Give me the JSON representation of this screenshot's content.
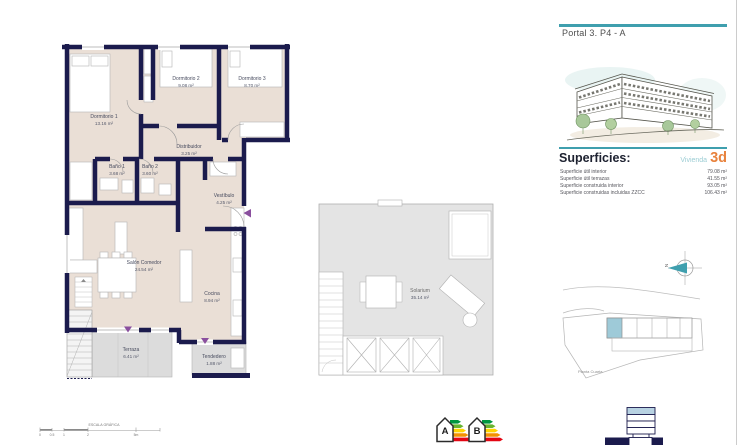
{
  "panel": {
    "portal_title": "Portal 3. P4 - A",
    "superficies_heading": "Superficies:",
    "vivienda_label": "Vivienda",
    "vivienda_code": "3d",
    "surface_rows": [
      {
        "label": "Superficie útil interior",
        "value": "79.08 m²"
      },
      {
        "label": "Superficie útil terrazas",
        "value": "41.55 m²"
      },
      {
        "label": "Superficie construida interior",
        "value": "93.05 m²"
      },
      {
        "label": "Superficie construidas incluidas ZZCC",
        "value": "106.43 m²"
      }
    ],
    "site_plan_caption": "Planta Cuarta",
    "north_label": "N"
  },
  "floor_plan": {
    "rooms": [
      {
        "name": "Dormitorio 1",
        "area": "13.16 m²"
      },
      {
        "name": "Dormitorio 2",
        "area": "9.08 m²"
      },
      {
        "name": "Dormitorio 3",
        "area": "8.70 m²"
      },
      {
        "name": "Distribuidor",
        "area": "3.25 m²"
      },
      {
        "name": "Baño 1",
        "area": "3.68 m²"
      },
      {
        "name": "Baño 2",
        "area": "3.60 m²"
      },
      {
        "name": "Vestíbulo",
        "area": "4.25 m²"
      },
      {
        "name": "Salón Comedor",
        "area": "24.54 m²"
      },
      {
        "name": "Cocina",
        "area": "8.94 m²"
      },
      {
        "name": "Terraza",
        "area": "6.41 m²"
      },
      {
        "name": "Tendedero",
        "area": "1.88 m²"
      }
    ]
  },
  "roof_plan": {
    "room": {
      "name": "Solarium",
      "area": "35.14 m²"
    }
  },
  "scale_bar": {
    "title": "ESCALA GRÁFICA",
    "ticks": [
      "0",
      "0.5",
      "1",
      "2",
      "5m"
    ]
  },
  "energy_labels": {
    "items": [
      {
        "letter": "A"
      },
      {
        "letter": "B"
      }
    ]
  },
  "icons": {
    "north_compass": "north-compass-icon",
    "energy_a": "energy-rating-a-icon",
    "energy_b": "energy-rating-b-icon",
    "building_section": "building-section-icon"
  },
  "colors": {
    "accent_teal": "#3f9fae",
    "accent_orange": "#e8823d",
    "wall_navy": "#1b1b4d",
    "floor_beige": "#eadfd6",
    "terrace_gray": "#dcdcdc",
    "unit_highlight": "#9ecad8",
    "marker_purple": "#8a4f9e"
  }
}
